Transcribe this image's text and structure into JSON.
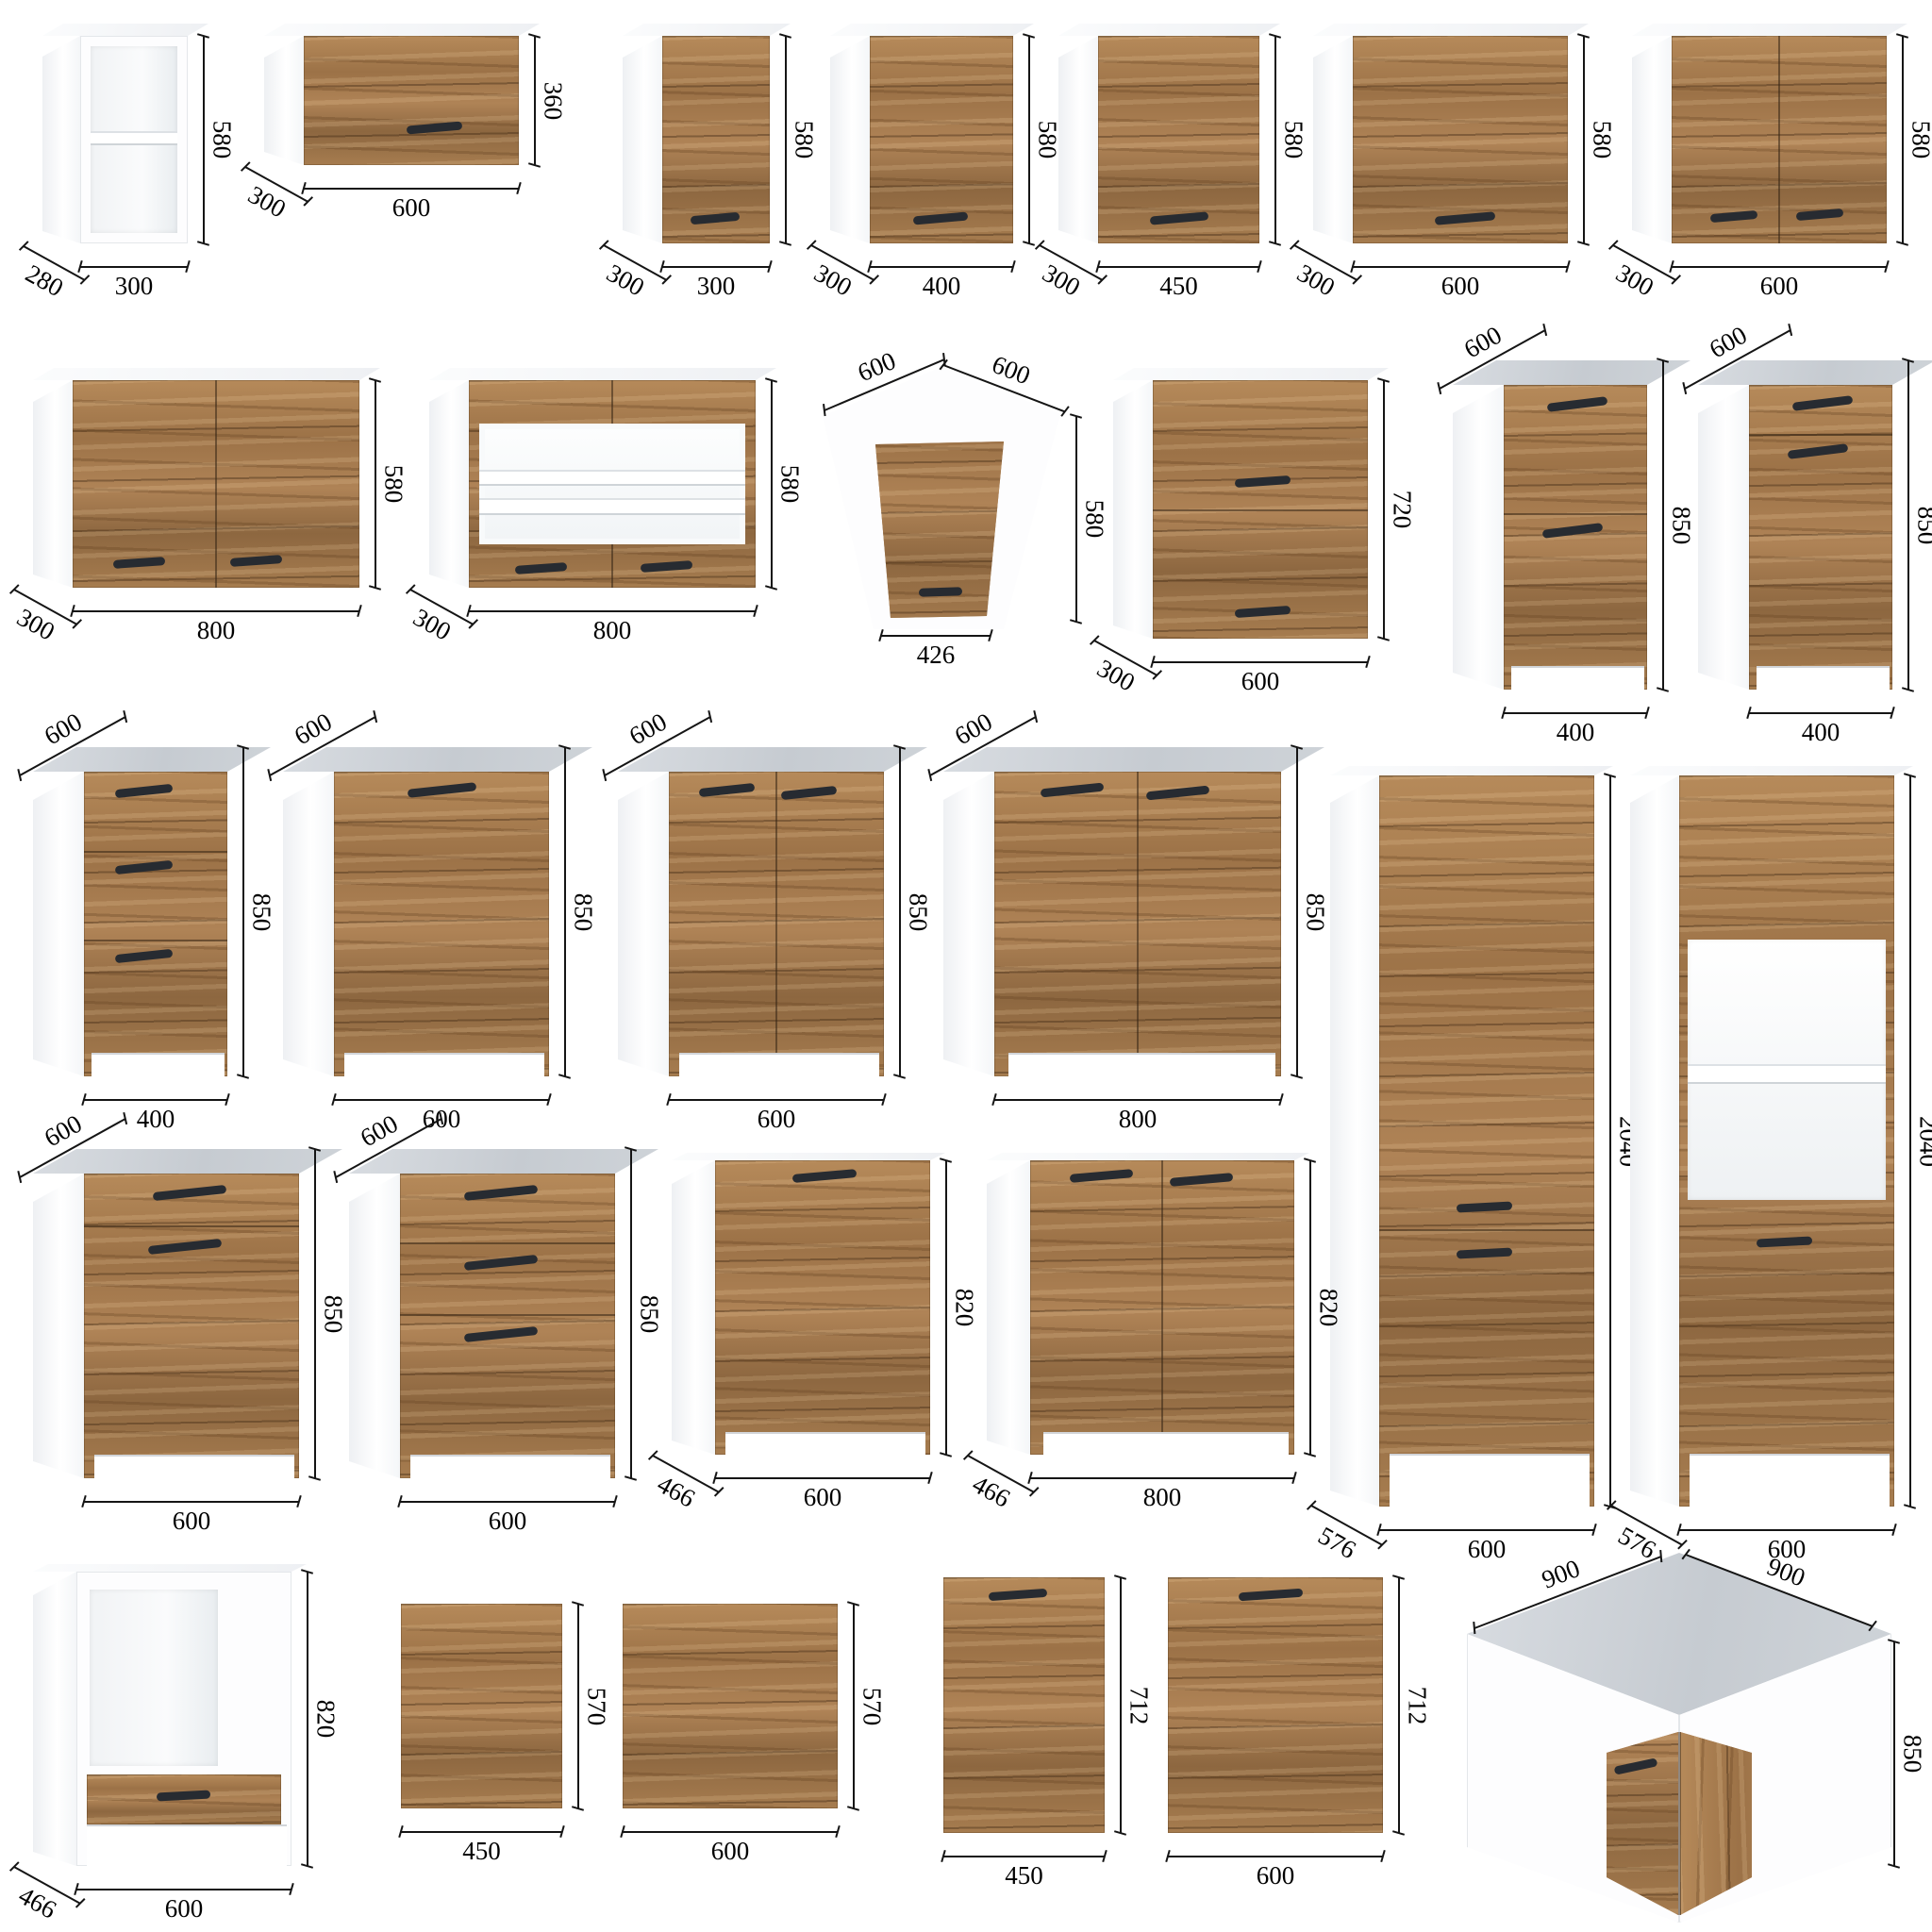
{
  "page": {
    "title": "kitchen-cabinet-dimension-catalog",
    "units": "mm"
  },
  "palette": {
    "wood": "#a87d50",
    "wood_dark": "#6f4f2d",
    "worktop_gray": "#c9ced4",
    "carcass_white": "#ffffff",
    "handle_dark": "#272b31",
    "dimension_ink": "#151515"
  },
  "items": [
    {
      "id": "open-shelf-300",
      "type": "open-shelf",
      "labels": {
        "width": "300",
        "height": "580",
        "depth": "280"
      }
    },
    {
      "id": "wall-flap-600",
      "type": "wall-flap",
      "labels": {
        "width": "600",
        "height": "360",
        "depth": "300"
      }
    },
    {
      "id": "wall-door-300",
      "type": "wall-door",
      "labels": {
        "width": "300",
        "height": "580",
        "depth": "300"
      }
    },
    {
      "id": "wall-door-400",
      "type": "wall-door",
      "labels": {
        "width": "400",
        "height": "580",
        "depth": "300"
      }
    },
    {
      "id": "wall-door-450",
      "type": "wall-door",
      "labels": {
        "width": "450",
        "height": "580",
        "depth": "300"
      }
    },
    {
      "id": "wall-door-600",
      "type": "wall-door",
      "labels": {
        "width": "600",
        "height": "580",
        "depth": "300"
      }
    },
    {
      "id": "wall-2door-600",
      "type": "wall-2door",
      "labels": {
        "width": "600",
        "height": "580",
        "depth": "300"
      }
    },
    {
      "id": "wall-2door-800",
      "type": "wall-2door",
      "labels": {
        "width": "800",
        "height": "580",
        "depth": "300"
      }
    },
    {
      "id": "wall-glass-800",
      "type": "wall-glass",
      "labels": {
        "width": "800",
        "height": "580",
        "depth": "300"
      }
    },
    {
      "id": "wall-corner-600",
      "type": "wall-corner",
      "labels": {
        "width_left": "600",
        "width_right": "600",
        "height": "580",
        "door": "426"
      }
    },
    {
      "id": "wall-2flap-600x720",
      "type": "wall-2flap",
      "labels": {
        "width": "600",
        "height": "720",
        "depth": "300"
      }
    },
    {
      "id": "base-400-door-split",
      "type": "base-door-split",
      "labels": {
        "width": "400",
        "height": "850",
        "depth": "600"
      }
    },
    {
      "id": "base-400-drawer-door",
      "type": "base-drawer-door",
      "labels": {
        "width": "400",
        "height": "850",
        "depth": "600"
      }
    },
    {
      "id": "base-400-drawers",
      "type": "base-drawers",
      "labels": {
        "width": "400",
        "height": "850",
        "depth": "600"
      }
    },
    {
      "id": "base-600-door",
      "type": "base-door",
      "labels": {
        "width": "600",
        "height": "850",
        "depth": "600"
      }
    },
    {
      "id": "base-600-2door",
      "type": "base-2door",
      "labels": {
        "width": "600",
        "height": "850",
        "depth": "600"
      }
    },
    {
      "id": "base-800-2door",
      "type": "base-2door",
      "labels": {
        "width": "800",
        "height": "850",
        "depth": "600"
      }
    },
    {
      "id": "tall-600-doors",
      "type": "tall-doors",
      "labels": {
        "width": "600",
        "height": "2040",
        "depth": "576"
      }
    },
    {
      "id": "tall-600-oven-niche",
      "type": "tall-oven",
      "labels": {
        "width": "600",
        "height": "2040",
        "depth": "576"
      }
    },
    {
      "id": "base-600-drawer-door",
      "type": "base-drawer-door",
      "labels": {
        "width": "600",
        "height": "850",
        "depth": "600"
      }
    },
    {
      "id": "base-600-drawers",
      "type": "base-drawers",
      "labels": {
        "width": "600",
        "height": "850",
        "depth": "600"
      }
    },
    {
      "id": "low-600-door",
      "type": "lowbase-door",
      "labels": {
        "width": "600",
        "height": "820",
        "depth": "466"
      }
    },
    {
      "id": "low-800-2door",
      "type": "lowbase-2door",
      "labels": {
        "width": "800",
        "height": "820",
        "depth": "466"
      }
    },
    {
      "id": "oven-housing-600",
      "type": "oven-housing",
      "labels": {
        "width": "600",
        "height": "820",
        "depth": "466"
      }
    },
    {
      "id": "panel-450x570",
      "type": "panel",
      "labels": {
        "width": "450",
        "height": "570"
      }
    },
    {
      "id": "panel-600x570",
      "type": "panel",
      "labels": {
        "width": "600",
        "height": "570"
      }
    },
    {
      "id": "door-450x712",
      "type": "panel-handle",
      "labels": {
        "width": "450",
        "height": "712"
      }
    },
    {
      "id": "door-600x712",
      "type": "panel-handle",
      "labels": {
        "width": "600",
        "height": "712"
      }
    },
    {
      "id": "corner-base-900",
      "type": "base-corner",
      "labels": {
        "width_left": "900",
        "width_right": "900",
        "height": "850"
      }
    }
  ]
}
